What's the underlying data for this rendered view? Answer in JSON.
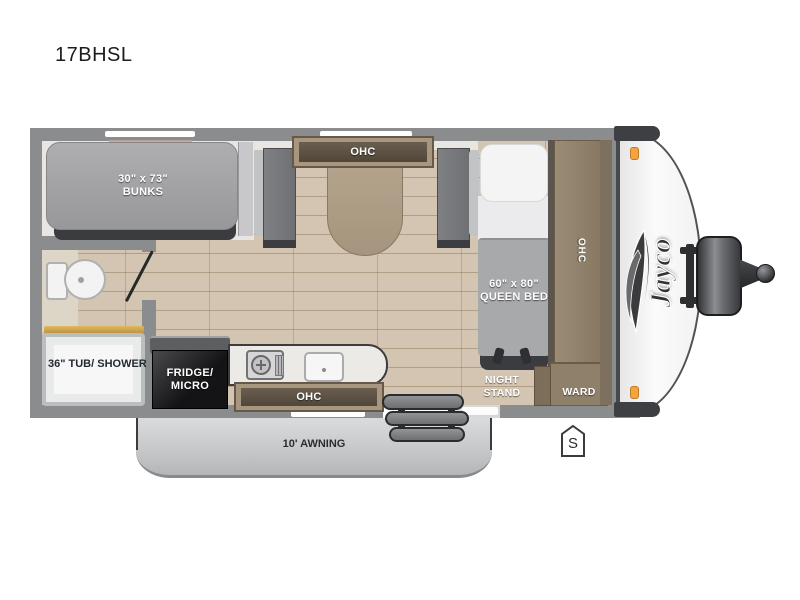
{
  "page": {
    "title": "17BHSL"
  },
  "fp": {
    "brand": "Jayco",
    "badge": "S",
    "awning": "10' AWNING",
    "bunks": {
      "l1": "30\" x 73\"",
      "l2": "BUNKS"
    },
    "dinette_ohc": "OHC",
    "queen": {
      "l1": "60\" x 80\"",
      "l2": "QUEEN BED"
    },
    "side_ohc": "OHC",
    "night": {
      "l1": "NIGHT",
      "l2": "STAND"
    },
    "ward": "WARD",
    "tub": {
      "l1": "36\" TUB/",
      "l2": "SHOWER"
    },
    "fridge": {
      "l1": "FRIDGE/",
      "l2": "MICRO"
    },
    "kitchen_ohc": "OHC",
    "icons": [
      "toilet-icon",
      "stove-burner-icon",
      "sink-icon",
      "window-strip",
      "door-swing-icon",
      "entry-steps-icon",
      "propane-tank-icon",
      "hitch-ball-icon",
      "marker-light-icon",
      "bird-logo-icon",
      "spare-badge-icon"
    ],
    "colors": {
      "wall": "#8b8c8e",
      "floor": "#d3c5b2",
      "cabinet": "#a8967e",
      "awning": "#c6c8ca",
      "marker_light": "#f5a243",
      "mattress": "#a2a2a4"
    }
  }
}
